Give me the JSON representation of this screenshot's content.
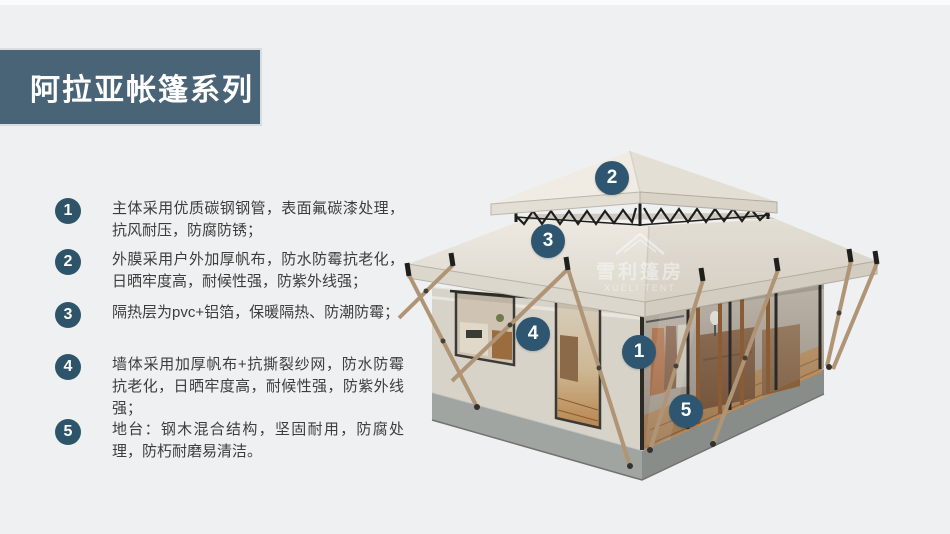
{
  "banner": {
    "title": "阿拉亚帐篷系列"
  },
  "features": [
    {
      "num": "1",
      "text": "主体采用优质碳钢钢管，表面氟碳漆处理，抗风耐压，防腐防锈；"
    },
    {
      "num": "2",
      "text": "外膜采用户外加厚帆布，防水防霉抗老化，日晒牢度高，耐候性强，防紫外线强；"
    },
    {
      "num": "3",
      "text": "隔热层为pvc+铝箔，保暖隔热、防潮防霉；"
    },
    {
      "num": "4",
      "text": "墙体采用加厚帆布+抗撕裂纱网，防水防霉抗老化，日晒牢度高，耐候性强，防紫外线强；"
    },
    {
      "num": "5",
      "text": "地台：钢木混合结构，坚固耐用，防腐处理，防朽耐磨易清洁。"
    }
  ],
  "diagram": {
    "badge_color": "#2e5670",
    "watermark": {
      "cn": "雪利篷房",
      "en": "XUELI TENT"
    },
    "callouts": [
      {
        "num": "2",
        "x": 612,
        "y": 178
      },
      {
        "num": "3",
        "x": 548,
        "y": 241
      },
      {
        "num": "4",
        "x": 533,
        "y": 334
      },
      {
        "num": "1",
        "x": 639,
        "y": 352
      },
      {
        "num": "5",
        "y": 411,
        "x": 686
      }
    ]
  },
  "colors": {
    "accent": "#4a6477",
    "background": "#eff0f1"
  }
}
